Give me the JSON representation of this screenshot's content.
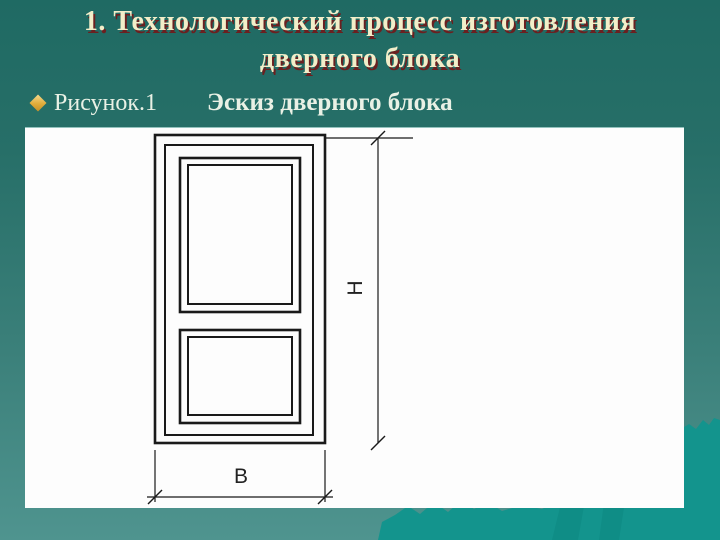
{
  "slide": {
    "title": {
      "line1": "1. Технологический процесс изготовления",
      "line2": "дверного блока"
    },
    "bullet_item": {
      "label": "Рисунок.1",
      "caption": "Эскиз дверного блока"
    }
  },
  "figure": {
    "width_label": "В",
    "height_label": "Н"
  },
  "colors": {
    "bg_top": "#1f6a63",
    "bg_bottom": "#4f948f",
    "hill": "#13948d",
    "canvas": "#fdfdfd",
    "ink": "#1a1a1a",
    "title_fill": "#f2eec9",
    "title_shadow": "#6b2020",
    "text_light": "#e9f1e5",
    "bullet_gold": "#e0ac3a"
  }
}
